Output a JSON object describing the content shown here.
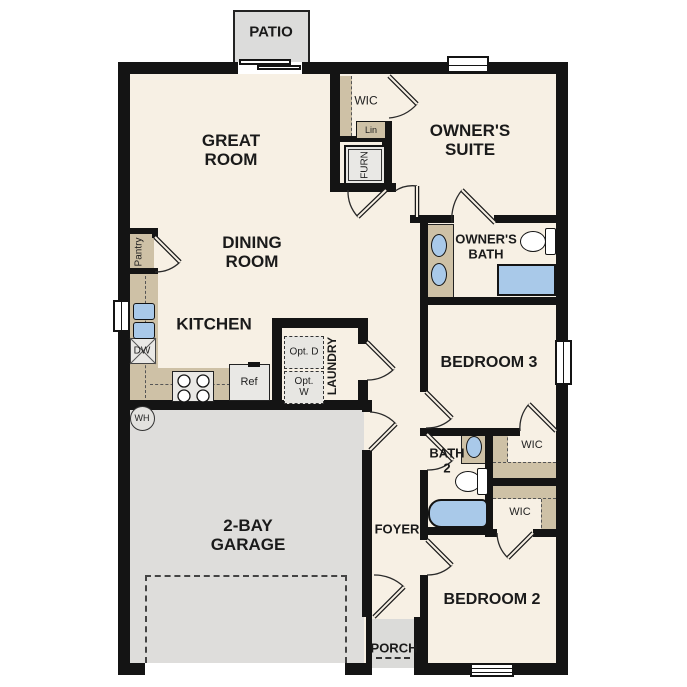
{
  "labels": {
    "patio": "PATIO",
    "great_room": "GREAT ROOM",
    "wic_owner": "WIC",
    "lin": "Lin",
    "furn": "FURN",
    "owners_suite": "OWNER'S SUITE",
    "owners_bath": "OWNER'S BATH",
    "pantry": "Pantry",
    "dining_room": "DINING ROOM",
    "kitchen": "KITCHEN",
    "dw": "DW",
    "ref": "Ref",
    "opt_d": "Opt. D",
    "opt_w": "Opt. W",
    "laundry": "LAUNDRY",
    "bedroom3": "BEDROOM 3",
    "wh": "WH",
    "bath2": "BATH 2",
    "wic_bed3": "WIC",
    "wic_bed2": "WIC",
    "garage": "2-BAY GARAGE",
    "foyer": "FOYER",
    "porch": "PORCH",
    "bedroom2": "BEDROOM 2"
  },
  "colors": {
    "interior_cream": "#f7f0e4",
    "wall_black": "#141414",
    "counter_tan": "#cec1a6",
    "concrete_gray": "#dedddb",
    "fixture_blue": "#a9c9e9",
    "appliance_gray": "#e9e8e5",
    "label_text": "#1a1a1a"
  }
}
